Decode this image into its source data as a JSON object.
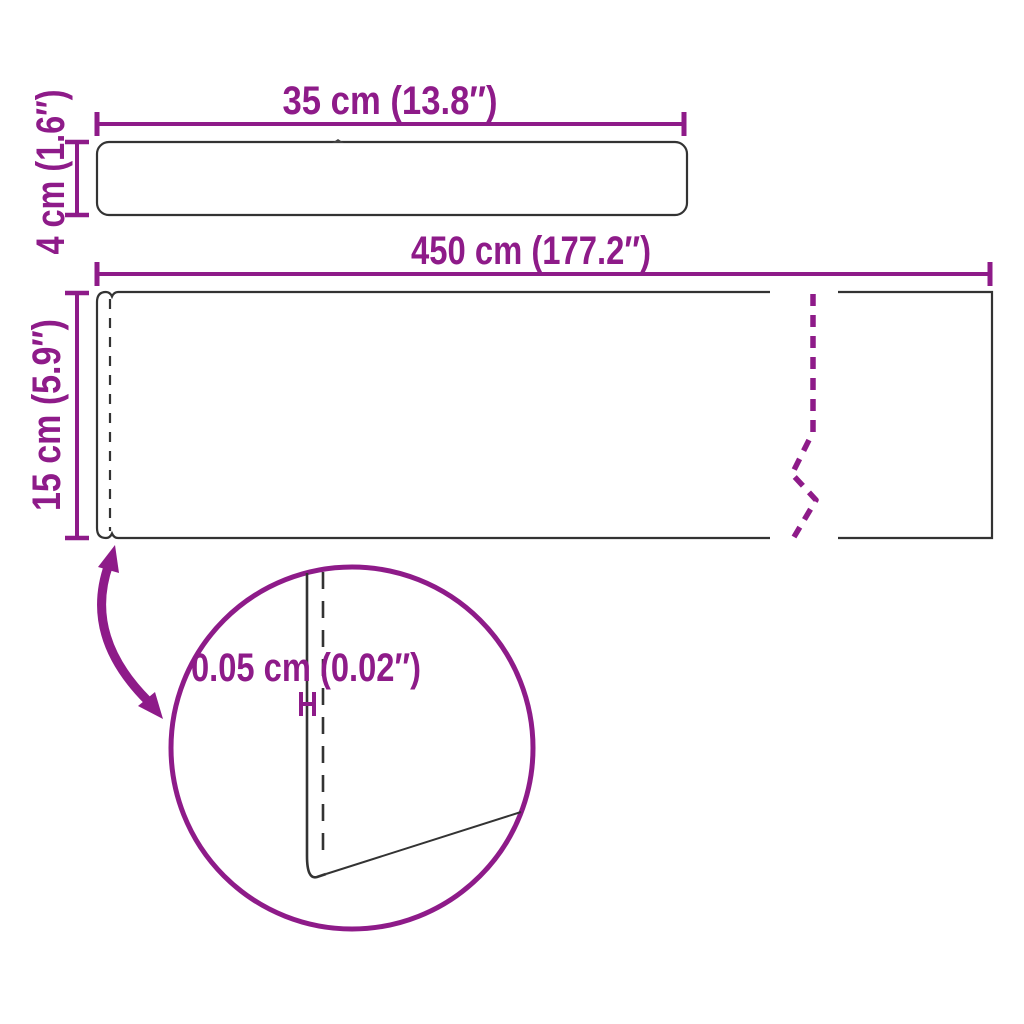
{
  "diagram": {
    "type": "product-dimension-drawing",
    "accent_color": "#8E1B89",
    "outline_color": "#333333",
    "top_profile": {
      "width_label": "35 cm (13.8″)",
      "thickness_label": "4 cm (1.6″)"
    },
    "roll_view": {
      "length_label": "450 cm (177.2″)",
      "height_label": "15 cm (5.9″)"
    },
    "detail_view": {
      "thickness_label": "0.05 cm (0.02″)"
    }
  }
}
